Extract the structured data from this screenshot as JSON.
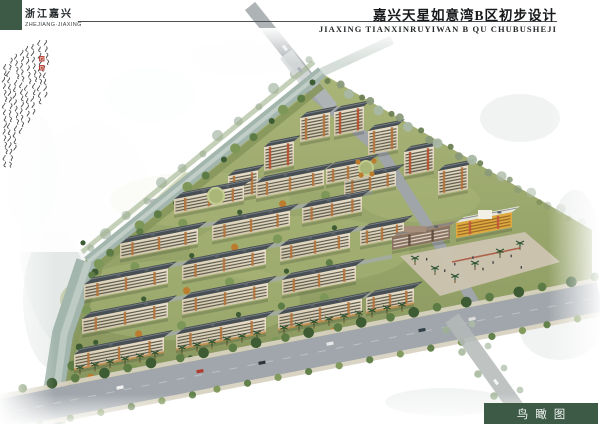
{
  "header": {
    "region_cn": "浙江嘉兴",
    "region_en": "ZHEJIANG·JIAXING",
    "title_cn": "嘉兴天星如意湾B区初步设计",
    "title_en": "JIAXING TIANXINRUYIWAN B QU CHUBUSHEJI"
  },
  "footer": {
    "view_label_cn": "鸟瞰图"
  },
  "annotation": {
    "type": "handwritten-calligraphy",
    "legible": false,
    "seal_count": 2
  },
  "palette": {
    "brand_green": "#3c5a46",
    "seal_red": "#b03024",
    "water": "#a3b6ae",
    "water_light": "#c8d4cd",
    "road": "#a0a6ab",
    "sidewalk": "#d8d2c0",
    "roof": "#474e54",
    "roof_ridge": "#7e858c",
    "facade": "#ded3b8",
    "facade_dark": "#cfc3a6",
    "facade_accent": "#b5743c",
    "window": "#43453a",
    "tree_dark": "#3d5c34",
    "tree_mid": "#5d7c45",
    "tree_light": "#7d9758",
    "tree_autumn": "#bc7c2f",
    "bank_green": "#87975c",
    "lawn": "#9aa76e",
    "lawn_light": "#aab578",
    "commercial_brown": "#7b6150",
    "kindergarten_yellow": "#e0a93f",
    "kindergarten_roof": "#e9e6db",
    "plaza": "#ccc4b0",
    "ink": "#333333"
  }
}
